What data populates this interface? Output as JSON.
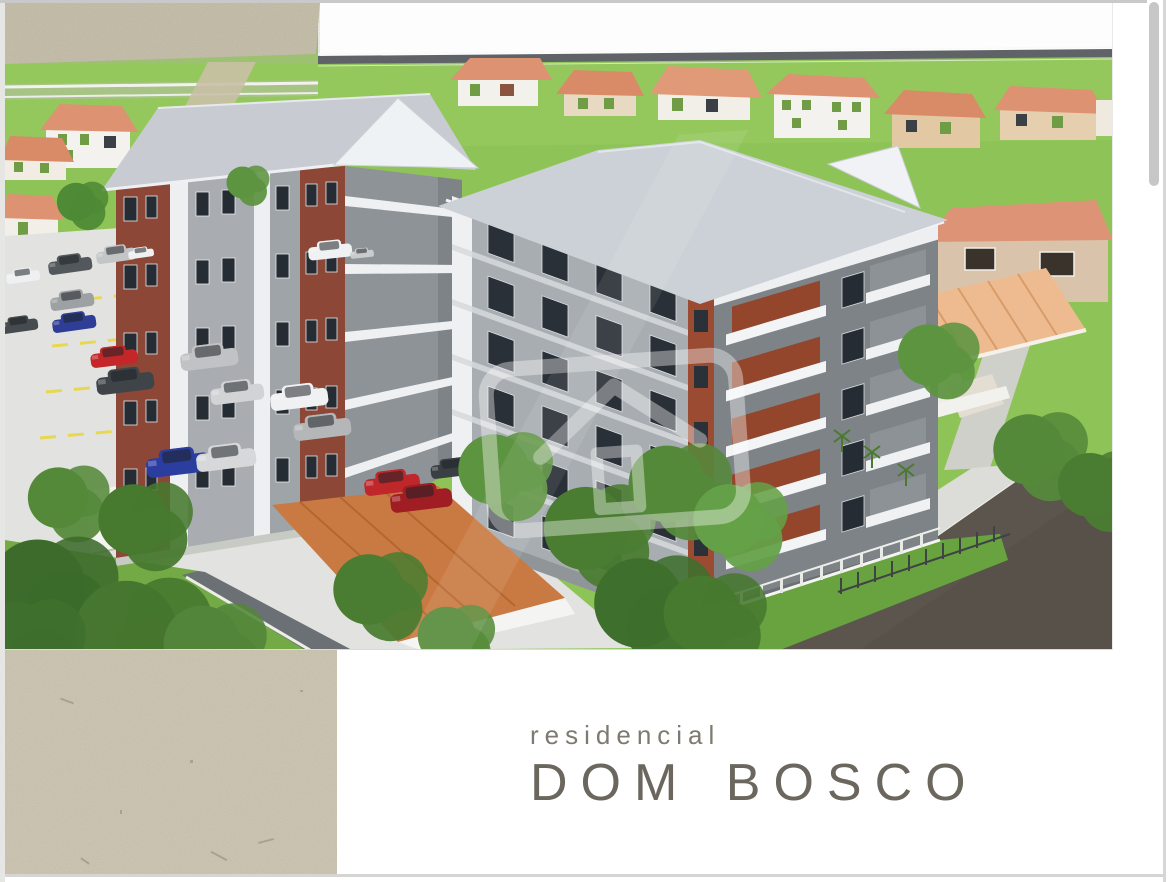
{
  "viewer": {
    "background": "#ffffff",
    "border_color": "#d5d5d3",
    "scrollbar_visible": true,
    "scrollbar_color": "#c7c7c7"
  },
  "flyer": {
    "brand": {
      "line1": "residencial",
      "line2": "DOM BOSCO",
      "line1_color": "#7e7a72",
      "line2_color": "#6b675f"
    },
    "paper_color": "#cdc6b2",
    "card_color": "#ffffff",
    "watermark_icon": "house-outline-in-rounded-square"
  },
  "scene": {
    "type": "architectural-3d-render",
    "subject": "aerial view of apartment complex with parking lot",
    "apartment_buildings": 2,
    "floors_per_building": 5,
    "cars_in_parking": 20,
    "palette": {
      "grass": "#8ec457",
      "roof_gray": "#ccd1d7",
      "brick_accent": "#9a4b31",
      "wall_gray": "#a8adb2",
      "wall_dark_gray": "#7e8388",
      "balcony_white": "#f2f4f6",
      "parking_concrete": "#e2e3e0",
      "parking_line_yellow": "#e8d84f",
      "house_roof_salmon": "#dd9272",
      "asphalt_dark": "#5b554d",
      "sky_white": "#fdfdfd",
      "gravel": "#c6bfa9"
    }
  }
}
